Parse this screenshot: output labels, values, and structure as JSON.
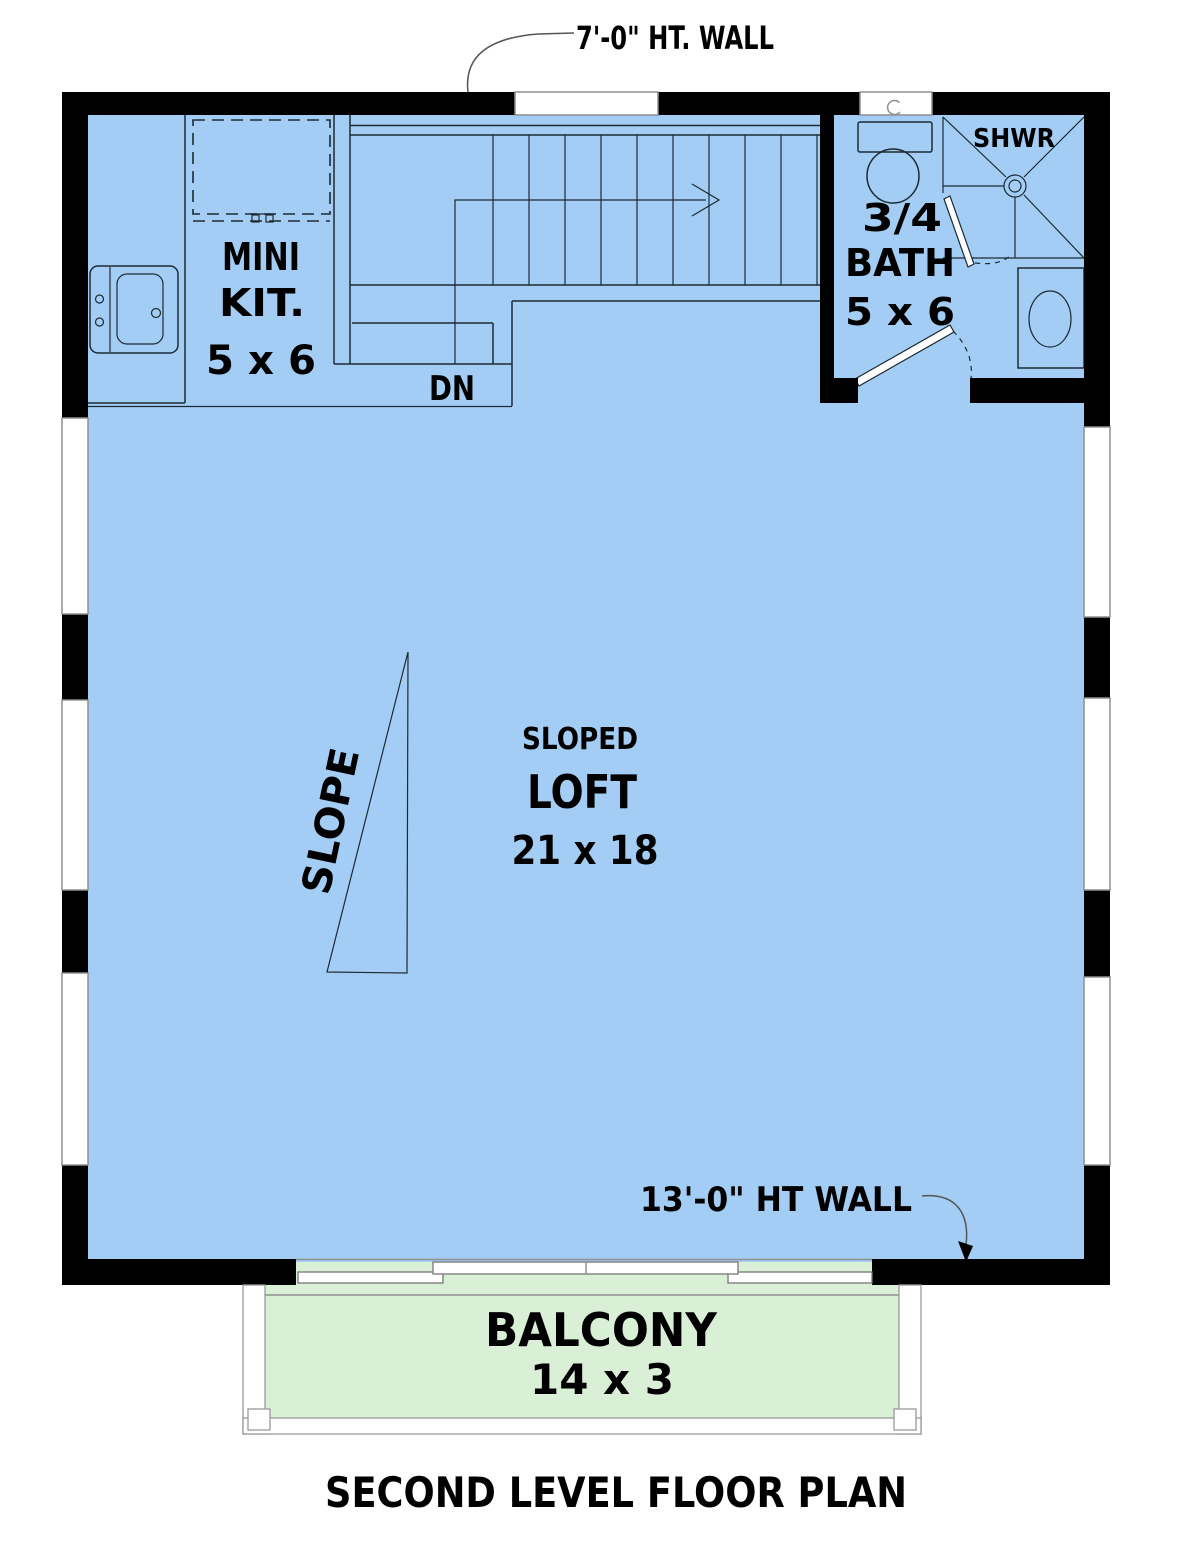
{
  "page": {
    "caption": "SECOND LEVEL FLOOR PLAN"
  },
  "annotations": {
    "top_wall_note": "7'-0\" HT. WALL",
    "bottom_wall_note": "13'-0\" HT WALL",
    "stair_direction": "DN",
    "slope_label": "SLOPE"
  },
  "rooms": {
    "mini_kitchen": {
      "name_line1": "MINI",
      "name_line2": "KIT.",
      "dimensions": "5 x 6"
    },
    "bath": {
      "name_line1": "3/4",
      "name_line2": "BATH",
      "dimensions": "5 x 6"
    },
    "shower": {
      "label": "SHWR"
    },
    "loft": {
      "descriptor": "SLOPED",
      "name": "LOFT",
      "dimensions": "21 x 18"
    },
    "balcony": {
      "name": "BALCONY",
      "dimensions": "14 x 3"
    }
  },
  "colors": {
    "interior_floor": "#a3cdf4",
    "balcony_floor": "#d9efd6",
    "walls": "#000000",
    "drawing_line": "#1c2b33",
    "frame_gray": "#8f8f8f"
  }
}
